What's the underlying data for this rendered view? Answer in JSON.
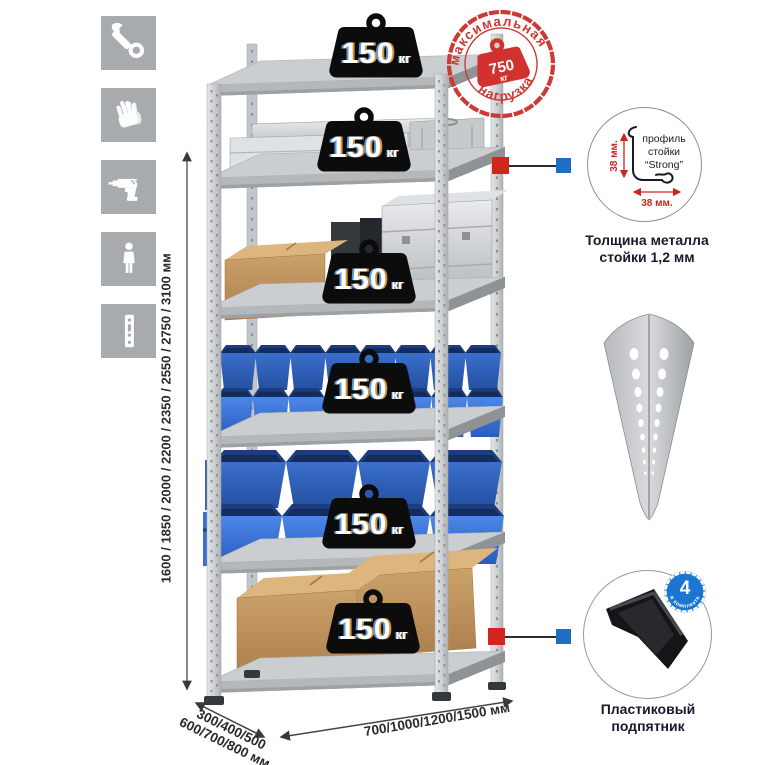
{
  "colors": {
    "accent_red": "#d2251c",
    "accent_blue": "#1e6fc4",
    "stamp_red": "#cc3a36",
    "tile_gray": "#a7abae"
  },
  "sidebar": {
    "icons": [
      {
        "name": "wrench"
      },
      {
        "name": "gloves"
      },
      {
        "name": "drill"
      },
      {
        "name": "person-height"
      },
      {
        "name": "perforated-profile"
      }
    ]
  },
  "stamp": {
    "arc_top": "максимальная",
    "arc_bottom": "нагрузка",
    "weight_value": "750",
    "weight_unit": "кг"
  },
  "rack": {
    "shelf_count": 6,
    "shelf_load": {
      "value": "150",
      "unit": "кг"
    }
  },
  "dimensions": {
    "height": "1600 / 1850 / 2000 / 2200 / 2350 / 2550 / 2750 / 3100 мм",
    "depth_line1": "300/400/500",
    "depth_line2": "600/700/800 мм",
    "width": "700/1000/1200/1500 мм"
  },
  "profile_detail": {
    "label_line1": "профиль",
    "label_line2": "стойки",
    "label_line3": "“Strong”",
    "dim_vertical": "38 мм.",
    "dim_horizontal": "38 мм.",
    "caption_line1": "Толщина металла",
    "caption_line2": "стойки 1,2 мм"
  },
  "foot_detail": {
    "badge_count": "4",
    "badge_caption": "в комплекте",
    "caption_line1": "Пластиковый",
    "caption_line2": "подпятник"
  }
}
